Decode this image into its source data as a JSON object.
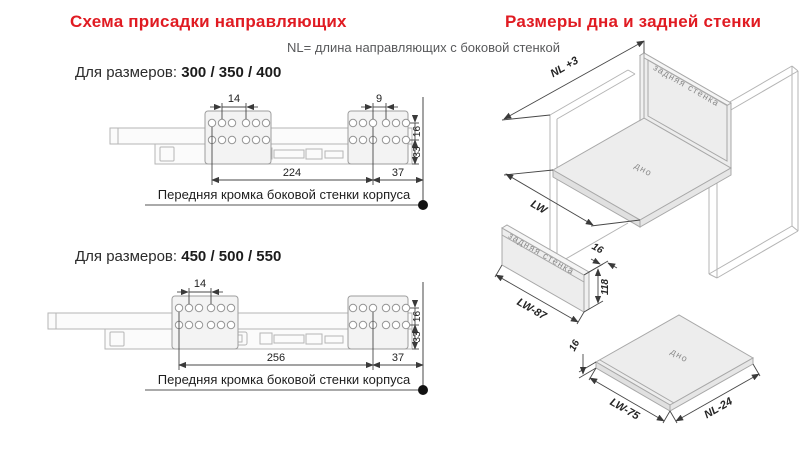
{
  "left_section": {
    "title": "Схема присадки направляющих",
    "note": "NL= длина направляющих с боковой стенкой",
    "diagrams": [
      {
        "sizes_label": "Для размеров:",
        "sizes_value": "300 / 350 / 400",
        "dims": {
          "hole_pitch_left": "14",
          "hole_pitch_right": "9",
          "row_gap": "16",
          "bottom_offset": "33",
          "front_distance": "224",
          "edge_distance": "37"
        },
        "front_edge_label": "Передняя кромка боковой стенки корпуса"
      },
      {
        "sizes_label": "Для размеров:",
        "sizes_value": "450 / 500 / 550",
        "dims": {
          "hole_pitch_left": "14",
          "row_gap": "16",
          "bottom_offset": "33",
          "front_distance": "256",
          "edge_distance": "37"
        },
        "front_edge_label": "Передняя кромка боковой стенки корпуса"
      }
    ]
  },
  "right_section": {
    "title": "Размеры дна и задней стенки",
    "cabinet": {
      "depth_dim": "NL +3",
      "width_dim": "LW",
      "back_wall_label": "задняя стенка",
      "bottom_label": "дно"
    },
    "back_panel": {
      "label": "задняя стенка",
      "width_dim": "LW-87",
      "thickness_dim": "16",
      "height_dim": "118"
    },
    "bottom_panel": {
      "label": "дно",
      "width_dim": "LW-75",
      "depth_dim": "NL-24",
      "thickness_dim": "16"
    }
  },
  "colors": {
    "accent_red": "#e01b22",
    "note_gray": "#58595b",
    "drawing_gray": "#b0b0b0",
    "dim_dark": "#3a3a3a",
    "panel_fill": "#ededed"
  }
}
